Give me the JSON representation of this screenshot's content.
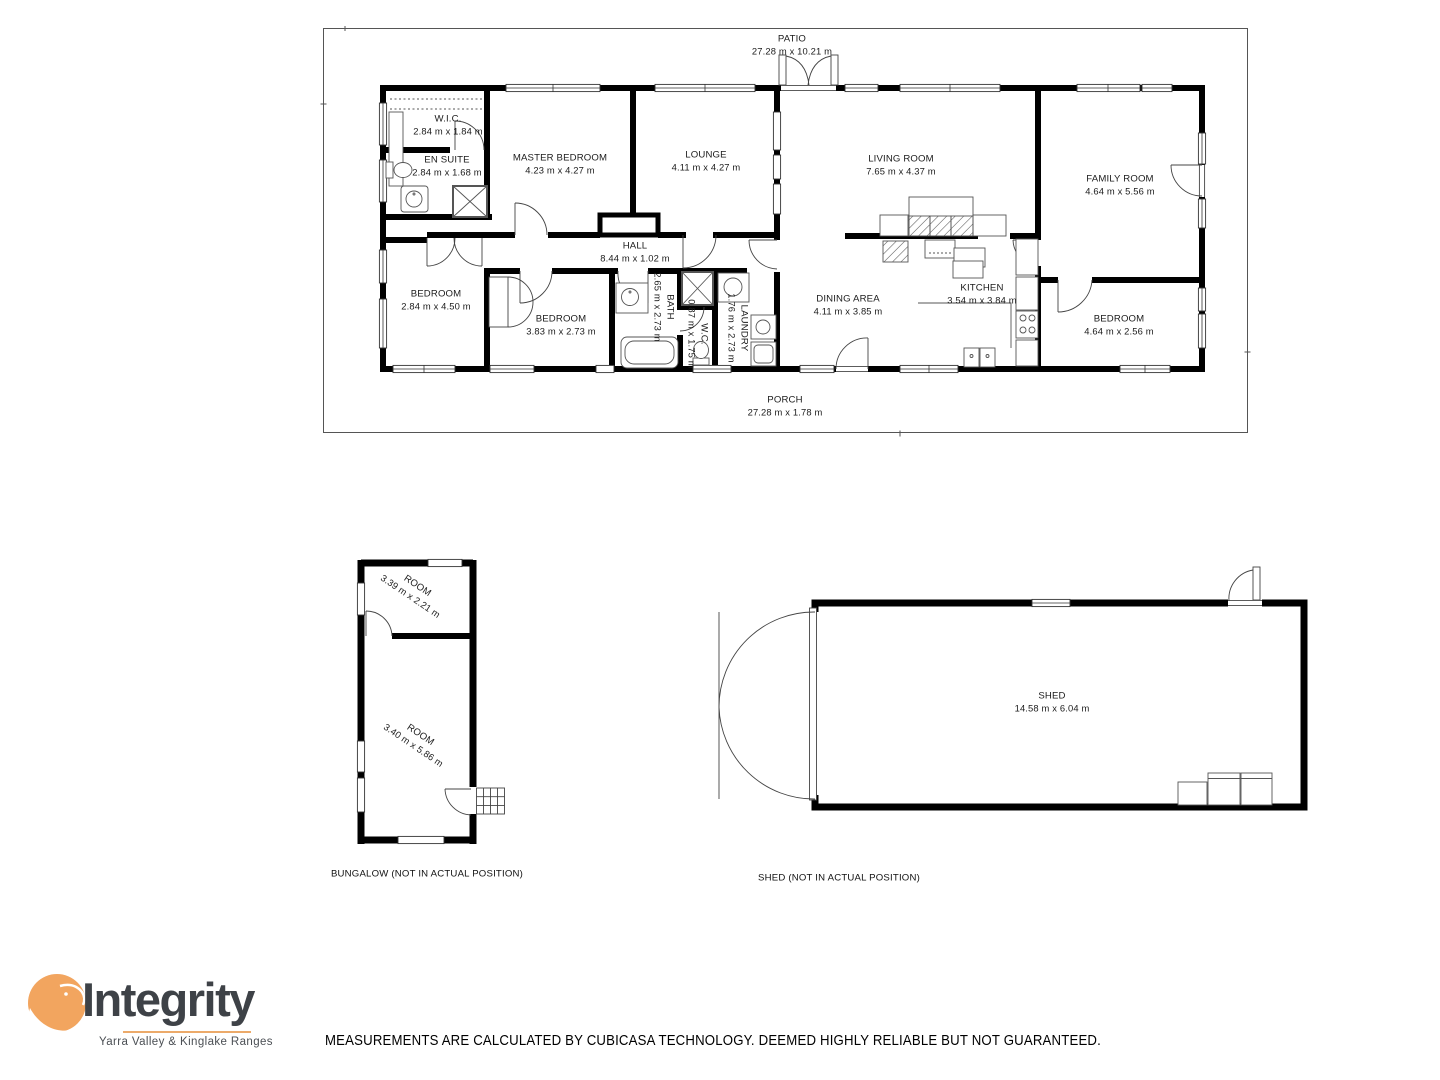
{
  "plan": {
    "rooms": {
      "patio": {
        "name": "PATIO",
        "dims": "27.28 m x 10.21 m"
      },
      "wic": {
        "name": "W.I.C.",
        "dims": "2.84 m x 1.84 m"
      },
      "ensuite": {
        "name": "EN SUITE",
        "dims": "2.84 m x 1.68 m"
      },
      "master": {
        "name": "MASTER BEDROOM",
        "dims": "4.23 m x 4.27 m"
      },
      "lounge": {
        "name": "LOUNGE",
        "dims": "4.11 m x 4.27 m"
      },
      "living": {
        "name": "LIVING ROOM",
        "dims": "7.65 m x 4.37 m"
      },
      "family": {
        "name": "FAMILY ROOM",
        "dims": "4.64 m x 5.56 m"
      },
      "hall": {
        "name": "HALL",
        "dims": "8.44 m x 1.02 m"
      },
      "bedroom_left": {
        "name": "BEDROOM",
        "dims": "2.84 m x 4.50 m"
      },
      "bedroom_mid": {
        "name": "BEDROOM",
        "dims": "3.83 m x 2.73 m"
      },
      "bath": {
        "name": "BATH",
        "dims": "2.65 m x 2.73 m"
      },
      "wc": {
        "name": "W.C.",
        "dims": "0.87 m x 1.75 m"
      },
      "laundry": {
        "name": "LAUNDRY",
        "dims": "1.76 m x 2.73 m"
      },
      "dining": {
        "name": "DINING AREA",
        "dims": "4.11 m x 3.85 m"
      },
      "kitchen": {
        "name": "KITCHEN",
        "dims": "3.54 m x 3.84 m"
      },
      "bedroom_right": {
        "name": "BEDROOM",
        "dims": "4.64 m x 2.56 m"
      },
      "porch": {
        "name": "PORCH",
        "dims": "27.28 m x 1.78 m"
      }
    }
  },
  "bungalow": {
    "room_top": {
      "name": "ROOM",
      "dims": "3.39 m x 2.21 m"
    },
    "room_bottom": {
      "name": "ROOM",
      "dims": "3.40 m x 5.86 m"
    },
    "caption": "BUNGALOW (NOT IN ACTUAL POSITION)"
  },
  "shed": {
    "room": {
      "name": "SHED",
      "dims": "14.58 m x 6.04 m"
    },
    "caption": "SHED (NOT IN ACTUAL POSITION)"
  },
  "footer": {
    "brand": "Integrity",
    "tagline": "Yarra Valley & Kinglake Ranges",
    "disclaimer": "MEASUREMENTS ARE CALCULATED BY CUBICASA TECHNOLOGY. DEEMED HIGHLY RELIABLE BUT NOT GUARANTEED."
  },
  "colors": {
    "accent_orange": "#ECAA6A",
    "brand_text": "#3E4247",
    "wall": "#000000"
  }
}
